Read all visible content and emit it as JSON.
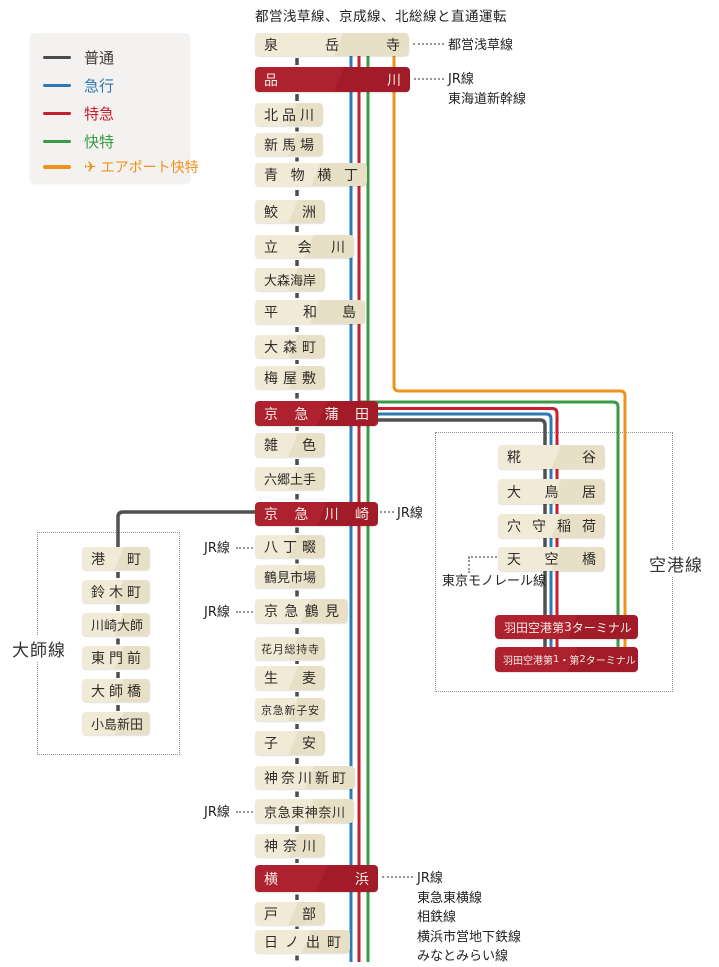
{
  "title": "都営浅草線、京成線、北総線と直通運転",
  "colors": {
    "local": "#4b4b4b",
    "express": "#2f78b1",
    "limited_express": "#c5202e",
    "rapid_limited_express": "#3a9a45",
    "airport_rapid": "#f0931d",
    "station_box": "#ece4cb",
    "major_station_box": "#a81f2a"
  },
  "legend": {
    "items": [
      {
        "label": "普通",
        "type": "local",
        "color": "#4b4b4b"
      },
      {
        "label": "急行",
        "type": "express",
        "color": "#2f78b1"
      },
      {
        "label": "特急",
        "type": "limited-express",
        "color": "#c5202e"
      },
      {
        "label": "快特",
        "type": "rapid-limited-express",
        "color": "#3a9a45"
      },
      {
        "label": "エアポート快特",
        "type": "airport-rapid",
        "color": "#f0931d",
        "icon": "airplane"
      }
    ]
  },
  "lines": {
    "main": {
      "stations": [
        {
          "name": "泉岳寺"
        },
        {
          "name": "品川",
          "major": true
        },
        {
          "name": "北品川"
        },
        {
          "name": "新馬場"
        },
        {
          "name": "青物横丁"
        },
        {
          "name": "鮫洲"
        },
        {
          "name": "立会川"
        },
        {
          "name": "大森海岸"
        },
        {
          "name": "平和島"
        },
        {
          "name": "大森町"
        },
        {
          "name": "梅屋敷"
        },
        {
          "name": "京急蒲田",
          "major": true
        },
        {
          "name": "雑色"
        },
        {
          "name": "六郷土手"
        },
        {
          "name": "京急川崎",
          "major": true
        },
        {
          "name": "八丁畷"
        },
        {
          "name": "鶴見市場"
        },
        {
          "name": "京急鶴見"
        },
        {
          "name": "花月総持寺"
        },
        {
          "name": "生麦"
        },
        {
          "name": "京急新子安"
        },
        {
          "name": "子安"
        },
        {
          "name": "神奈川新町"
        },
        {
          "name": "京急東神奈川"
        },
        {
          "name": "神奈川"
        },
        {
          "name": "横浜",
          "major": true
        },
        {
          "name": "戸部"
        },
        {
          "name": "日ノ出町"
        }
      ]
    },
    "daishi": {
      "label": "大師線",
      "stations": [
        {
          "name": "港町"
        },
        {
          "name": "鈴木町"
        },
        {
          "name": "川崎大師"
        },
        {
          "name": "東門前"
        },
        {
          "name": "大師橋"
        },
        {
          "name": "小島新田"
        }
      ]
    },
    "airport": {
      "label": "空港線",
      "stations": [
        {
          "name": "糀谷"
        },
        {
          "name": "大鳥居"
        },
        {
          "name": "穴守稲荷"
        },
        {
          "name": "天空橋"
        },
        {
          "name": "羽田空港第3ターミナル",
          "major": true
        },
        {
          "name": "羽田空港第1・第2ターミナル",
          "major": true
        }
      ]
    }
  },
  "annotations": {
    "right": [
      {
        "station": "泉岳寺",
        "lines": [
          "都営浅草線"
        ]
      },
      {
        "station": "品川",
        "lines": [
          "JR線",
          "東海道新幹線"
        ]
      },
      {
        "station": "京急川崎",
        "lines": [
          "JR線"
        ]
      },
      {
        "station": "横浜",
        "lines": [
          "JR線",
          "東急東横線",
          "相鉄線",
          "横浜市営地下鉄線",
          "みなとみらい線"
        ]
      }
    ],
    "left": [
      {
        "station": "八丁畷",
        "label": "JR線"
      },
      {
        "station": "京急鶴見",
        "label": "JR線"
      },
      {
        "station": "京急東神奈川",
        "label": "JR線"
      }
    ],
    "monorail": {
      "station": "天空橋",
      "label": "東京モノレール線"
    }
  }
}
